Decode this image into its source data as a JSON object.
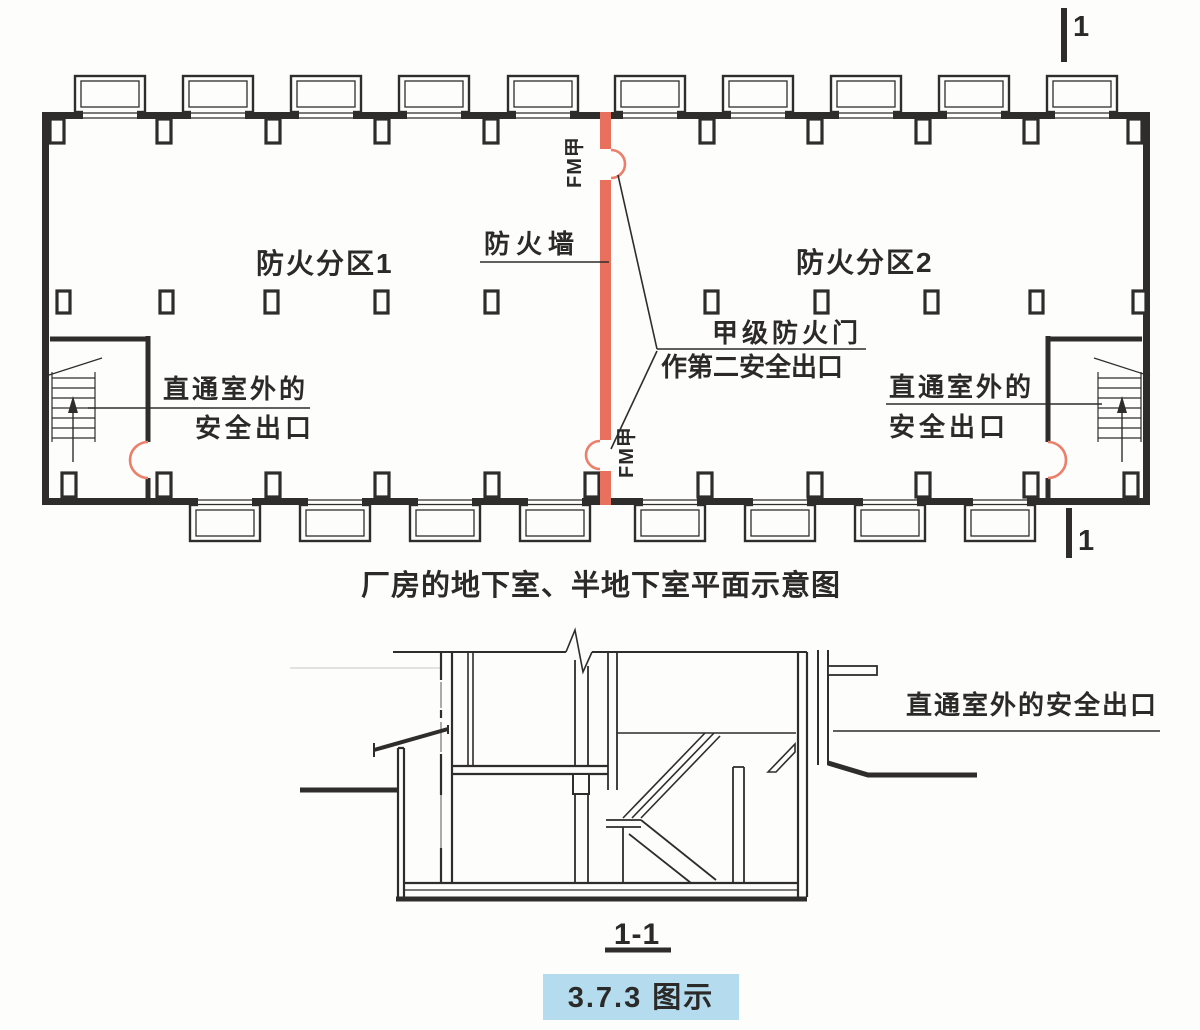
{
  "colors": {
    "fire_wall_red": "#e8705c",
    "door_arc_red": "#ec7e6a",
    "badge_bg": "#b4dcee",
    "badge_text": "#1b2733",
    "ink": "#2e2d2b"
  },
  "plan": {
    "zone1_label": "防火分区1",
    "zone2_label": "防火分区2",
    "fire_wall_label": "防火墙",
    "fire_door_top_label": "FM甲",
    "fire_door_bottom_label": "FM甲",
    "fire_door_note_line1": "甲级防火门",
    "fire_door_note_line2": "作第二安全出口",
    "exit_left_line1": "直通室外的",
    "exit_left_line2": "安全出口",
    "exit_right_line1": "直通室外的",
    "exit_right_line2": "安全出口",
    "caption": "厂房的地下室、半地下室平面示意图"
  },
  "section": {
    "exit_label": "直通室外的安全出口",
    "title": "1-1"
  },
  "section_markers": {
    "top": "1",
    "bottom": "1"
  },
  "footer": {
    "badge": "3.7.3 图示"
  }
}
